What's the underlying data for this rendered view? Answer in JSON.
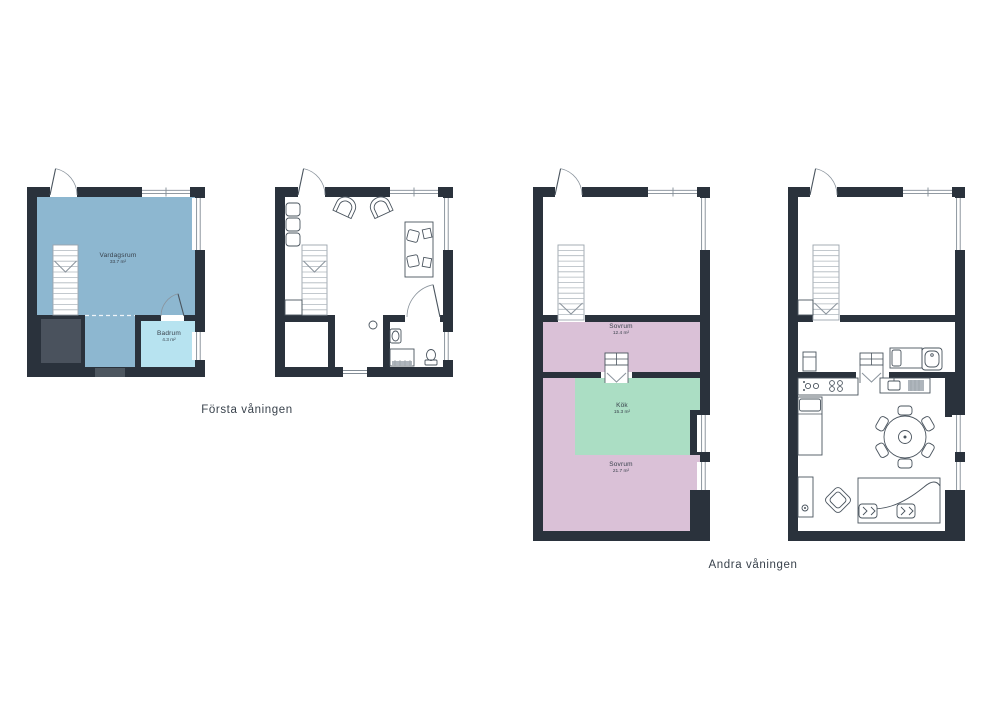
{
  "captions": {
    "first_floor": "Första våningen",
    "second_floor": "Andra våningen"
  },
  "floor1": {
    "vardagsrum": {
      "name": "Vardagsrum",
      "area": "33.7 m²"
    },
    "badrum": {
      "name": "Badrum",
      "area": "4.3 m²"
    }
  },
  "floor2": {
    "sovrum1": {
      "name": "Sovrum",
      "area": "12.4 m²"
    },
    "kok": {
      "name": "Kök",
      "area": "15.3 m²"
    },
    "sovrum2": {
      "name": "Sovrum",
      "area": "21.7 m²"
    }
  },
  "colors": {
    "wall": "#2A323C",
    "closet": "#4A525D",
    "living_blue": "#8DB7D0",
    "bath_blue": "#B7E3F0",
    "bedroom_pink": "#DAC1D7",
    "kitchen_green": "#ABDEC4",
    "threshold": "#4D565F",
    "background": "#FFFFFF"
  }
}
